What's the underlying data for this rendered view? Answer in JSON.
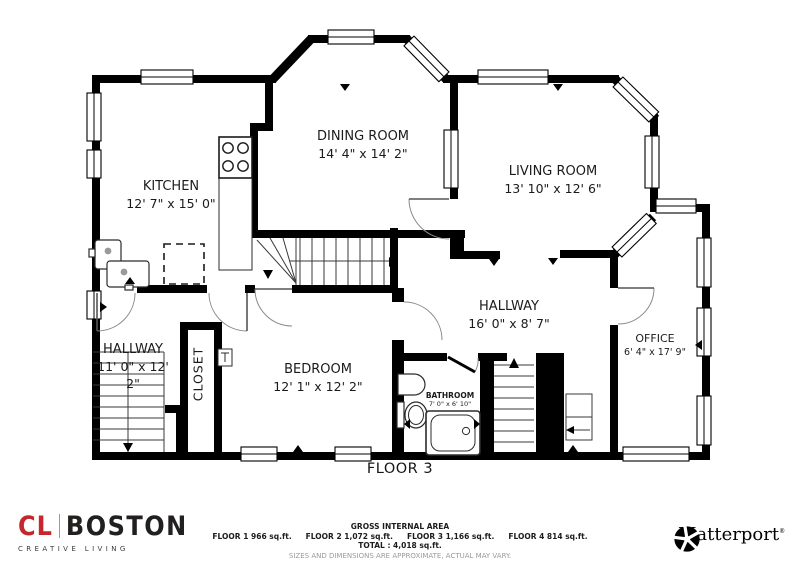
{
  "rooms": [
    {
      "name": "KITCHEN",
      "dims": "12' 7\" x 15' 0\""
    },
    {
      "name": "DINING ROOM",
      "dims": "14' 4\" x 14' 2\""
    },
    {
      "name": "LIVING ROOM",
      "dims": "13' 10\" x 12' 6\""
    },
    {
      "name": "HALLWAY",
      "dims": "16' 0\" x 8' 7\""
    },
    {
      "name": "OFFICE",
      "dims": "6' 4\" x 17' 9\""
    },
    {
      "name": "BEDROOM",
      "dims": "12' 1\" x 12' 2\""
    },
    {
      "name": "HALLWAY",
      "dims": "11' 0\" x 12' 2\""
    },
    {
      "name": "CLOSET",
      "dims": ""
    },
    {
      "name": "BATHROOM",
      "dims": "7' 0\" x 6' 10\""
    }
  ],
  "floor_label": "FLOOR 3",
  "footer": {
    "title": "GROSS INTERNAL AREA",
    "floors": [
      "FLOOR 1 966 sq.ft.",
      "FLOOR 2 1,072 sq.ft.",
      "FLOOR 3 1,166 sq.ft.",
      "FLOOR 4 814 sq.ft."
    ],
    "total": "TOTAL :  4,018 sq.ft.",
    "disclaimer": "SIZES AND DIMENSIONS ARE APPROXIMATE, ACTUAL MAY VARY."
  },
  "branding": {
    "cl": {
      "initials": "CL",
      "name": "BOSTON",
      "tagline": "CREATIVE LIVING",
      "accent": "#c4282d"
    },
    "matterport": {
      "name": "Matterport",
      "mark": "®"
    }
  },
  "colors": {
    "walls": "#000000",
    "lines": "#3a3a3a",
    "text": "#1b1b1b",
    "disclaimer": "#9a9a9a"
  }
}
